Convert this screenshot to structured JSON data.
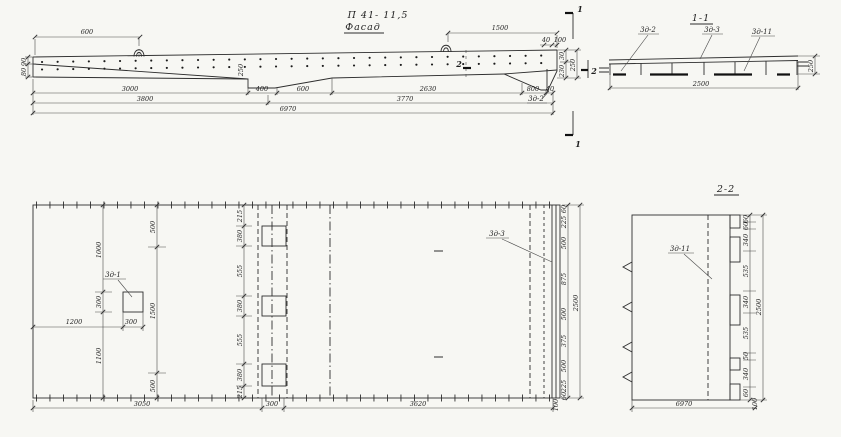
{
  "title": {
    "code": "П 41- 11,5",
    "label": "Фасад"
  },
  "facade": {
    "top_dims": [
      "600",
      "1500"
    ],
    "left_col": [
      "90",
      "80"
    ],
    "step_dim": "250",
    "inner_mark": "2",
    "right_top_dims": [
      "40",
      "100"
    ],
    "right_col1": [
      "30",
      "230"
    ],
    "right_col2": [
      "250"
    ],
    "row1": [
      "3000",
      "400",
      "600",
      "2630",
      "800",
      "40"
    ],
    "row2": [
      "3800",
      "3770"
    ],
    "row3": [
      "6970"
    ],
    "part_label": "3д-2",
    "section_mark_top": "1",
    "section_mark_bottom": "1",
    "section_mark_right": "2"
  },
  "section_1_1": {
    "title": "1-1",
    "part_labels": [
      "3д-2",
      "3д-3",
      "3д-11"
    ],
    "width_dim": "2500",
    "height_dim": "250"
  },
  "plan": {
    "col1": [
      "1000",
      "300",
      "1100"
    ],
    "col2": [
      "500",
      "1500",
      "500"
    ],
    "anchor_label": "3д-1",
    "edge_label": "3д-3",
    "dim_1200": "1200",
    "dim_300": "300",
    "rib_col": [
      "215",
      "380",
      "555",
      "380",
      "555",
      "380",
      "215"
    ],
    "right_col": [
      "60",
      "225",
      "500",
      "875",
      "500",
      "375",
      "500",
      "225",
      "60"
    ],
    "right_overall": "2500",
    "bottom": [
      "3050",
      "300",
      "3620"
    ],
    "corner_dim": "100"
  },
  "section_2_2": {
    "title": "2-2",
    "part_label": "3д-11",
    "right_col": [
      "60",
      "60",
      "340",
      "535",
      "340",
      "535",
      "50",
      "340",
      "60"
    ],
    "right_overall": "2500",
    "bottom_dim": "6970",
    "corner_dim": "100"
  }
}
